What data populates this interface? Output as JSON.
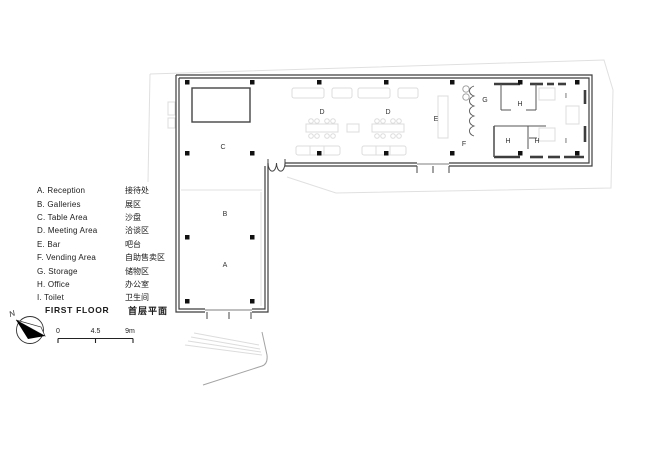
{
  "legend": {
    "items": [
      {
        "en": "A. Reception",
        "zh": "接待处"
      },
      {
        "en": "B. Galleries",
        "zh": "展区"
      },
      {
        "en": "C. Table Area",
        "zh": "沙盘"
      },
      {
        "en": "D. Meeting Area",
        "zh": "洽谈区"
      },
      {
        "en": "E. Bar",
        "zh": "吧台"
      },
      {
        "en": "F. Vending Area",
        "zh": "自助售卖区"
      },
      {
        "en": "G. Storage",
        "zh": "储物区"
      },
      {
        "en": "H. Office",
        "zh": "办公室"
      },
      {
        "en": "I. Toilet",
        "zh": "卫生间"
      }
    ]
  },
  "title": {
    "en": "FIRST FLOOR",
    "zh": "首层平面"
  },
  "north": {
    "label": "N"
  },
  "scale_bar": {
    "start": "0",
    "mid": "4.5",
    "end": "9m"
  },
  "plan": {
    "room_labels": [
      {
        "id": "table-area",
        "text": "C"
      },
      {
        "id": "meeting-area-1",
        "text": "D"
      },
      {
        "id": "meeting-area-2",
        "text": "D"
      },
      {
        "id": "bar",
        "text": "E"
      },
      {
        "id": "vending-area",
        "text": "F"
      },
      {
        "id": "storage",
        "text": "G"
      },
      {
        "id": "office-1",
        "text": "H"
      },
      {
        "id": "office-2",
        "text": "H"
      },
      {
        "id": "office-3",
        "text": "H"
      },
      {
        "id": "toilet-1",
        "text": "I"
      },
      {
        "id": "toilet-2",
        "text": "I"
      },
      {
        "id": "galleries",
        "text": "B"
      },
      {
        "id": "reception",
        "text": "A"
      }
    ]
  }
}
